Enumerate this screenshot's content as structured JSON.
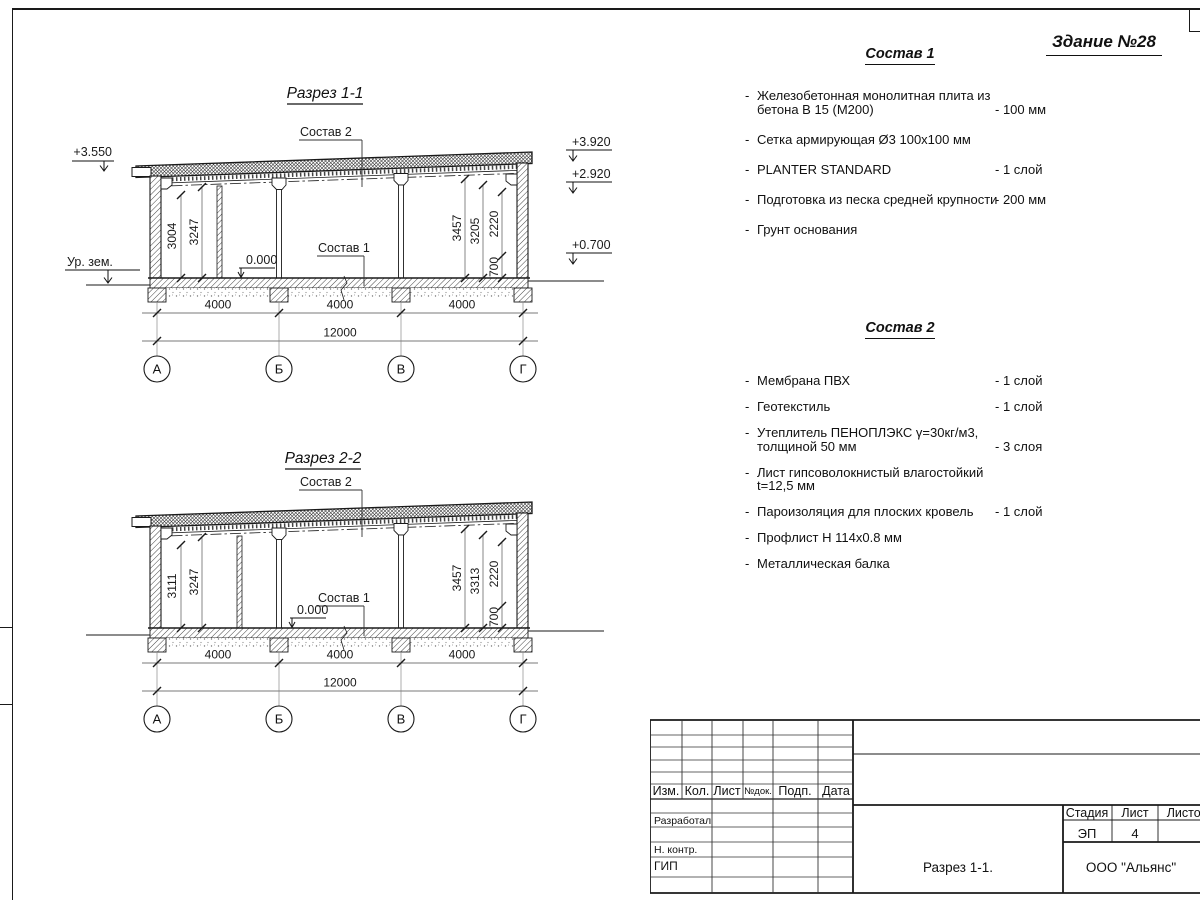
{
  "page": {
    "building_title": "Здание №28"
  },
  "sections": [
    {
      "title": "Разрез 1-1",
      "roof_label": "Состав 2",
      "floor_label": "Состав 1",
      "zero_mark": "0.000",
      "ground_label": "Ур. зем.",
      "elev_left": "+3.550",
      "elev_right": [
        "+3.920",
        "+2.920",
        "+0.700"
      ],
      "dims_left": [
        "3004",
        "3247"
      ],
      "dims_right": [
        "3457",
        "3205",
        "2220",
        "700"
      ],
      "span_dims": [
        "4000",
        "4000",
        "4000"
      ],
      "total_dim": "12000",
      "grid_labels": [
        "А",
        "Б",
        "В",
        "Г"
      ]
    },
    {
      "title": "Разрез 2-2",
      "roof_label": "Состав 2",
      "floor_label": "Состав 1",
      "zero_mark": "0.000",
      "dims_left": [
        "3111",
        "3247"
      ],
      "dims_right": [
        "3457",
        "3313",
        "2220",
        "700"
      ],
      "span_dims": [
        "4000",
        "4000",
        "4000"
      ],
      "total_dim": "12000",
      "grid_labels": [
        "А",
        "Б",
        "В",
        "Г"
      ]
    }
  ],
  "sostav1": {
    "title": "Состав 1",
    "marker": "-",
    "items": [
      {
        "text": "Железобетонная  монолитная плита из бетона В 15 (М200)",
        "value": "- 100 мм"
      },
      {
        "text": "Сетка армирующая Ø3 100х100 мм",
        "value": ""
      },
      {
        "text": "PLANTER STANDARD",
        "value": "- 1  слой"
      },
      {
        "text": "Подготовка из песка средней крупности",
        "value": "- 200 мм"
      },
      {
        "text": "Грунт основания",
        "value": ""
      }
    ]
  },
  "sostav2": {
    "title": "Состав 2",
    "marker": "-",
    "items": [
      {
        "text": "Мембрана ПВХ",
        "value": "- 1 слой"
      },
      {
        "text": "Геотекстиль",
        "value": "- 1 слой"
      },
      {
        "text": "Утеплитель ПЕНОПЛЭКС γ=30кг/м3, толщиной 50 мм",
        "value": "- 3 слоя"
      },
      {
        "text": "Лист гипсоволокнистый влагостойкий t=12,5 мм",
        "value": ""
      },
      {
        "text": "Пароизоляция для плоских кровель",
        "value": "- 1 слой"
      },
      {
        "text": "Профлист Н 114х0.8 мм",
        "value": ""
      },
      {
        "text": "Металлическая балка",
        "value": ""
      }
    ]
  },
  "titleblock": {
    "rev_headers": [
      "Изм.",
      "Кол.",
      "Лист",
      "№док.",
      "Подп.",
      "Дата"
    ],
    "sign_rows": [
      "Разработал",
      "Н. контр.",
      "ГИП"
    ],
    "stage_label": "Стадия",
    "sheet_label": "Лист",
    "sheets_label": "Листов",
    "stage_value": "ЭП",
    "sheet_value": "4",
    "doc_title": "Разрез 1-1.",
    "company": "ООО \"Альянс\""
  }
}
